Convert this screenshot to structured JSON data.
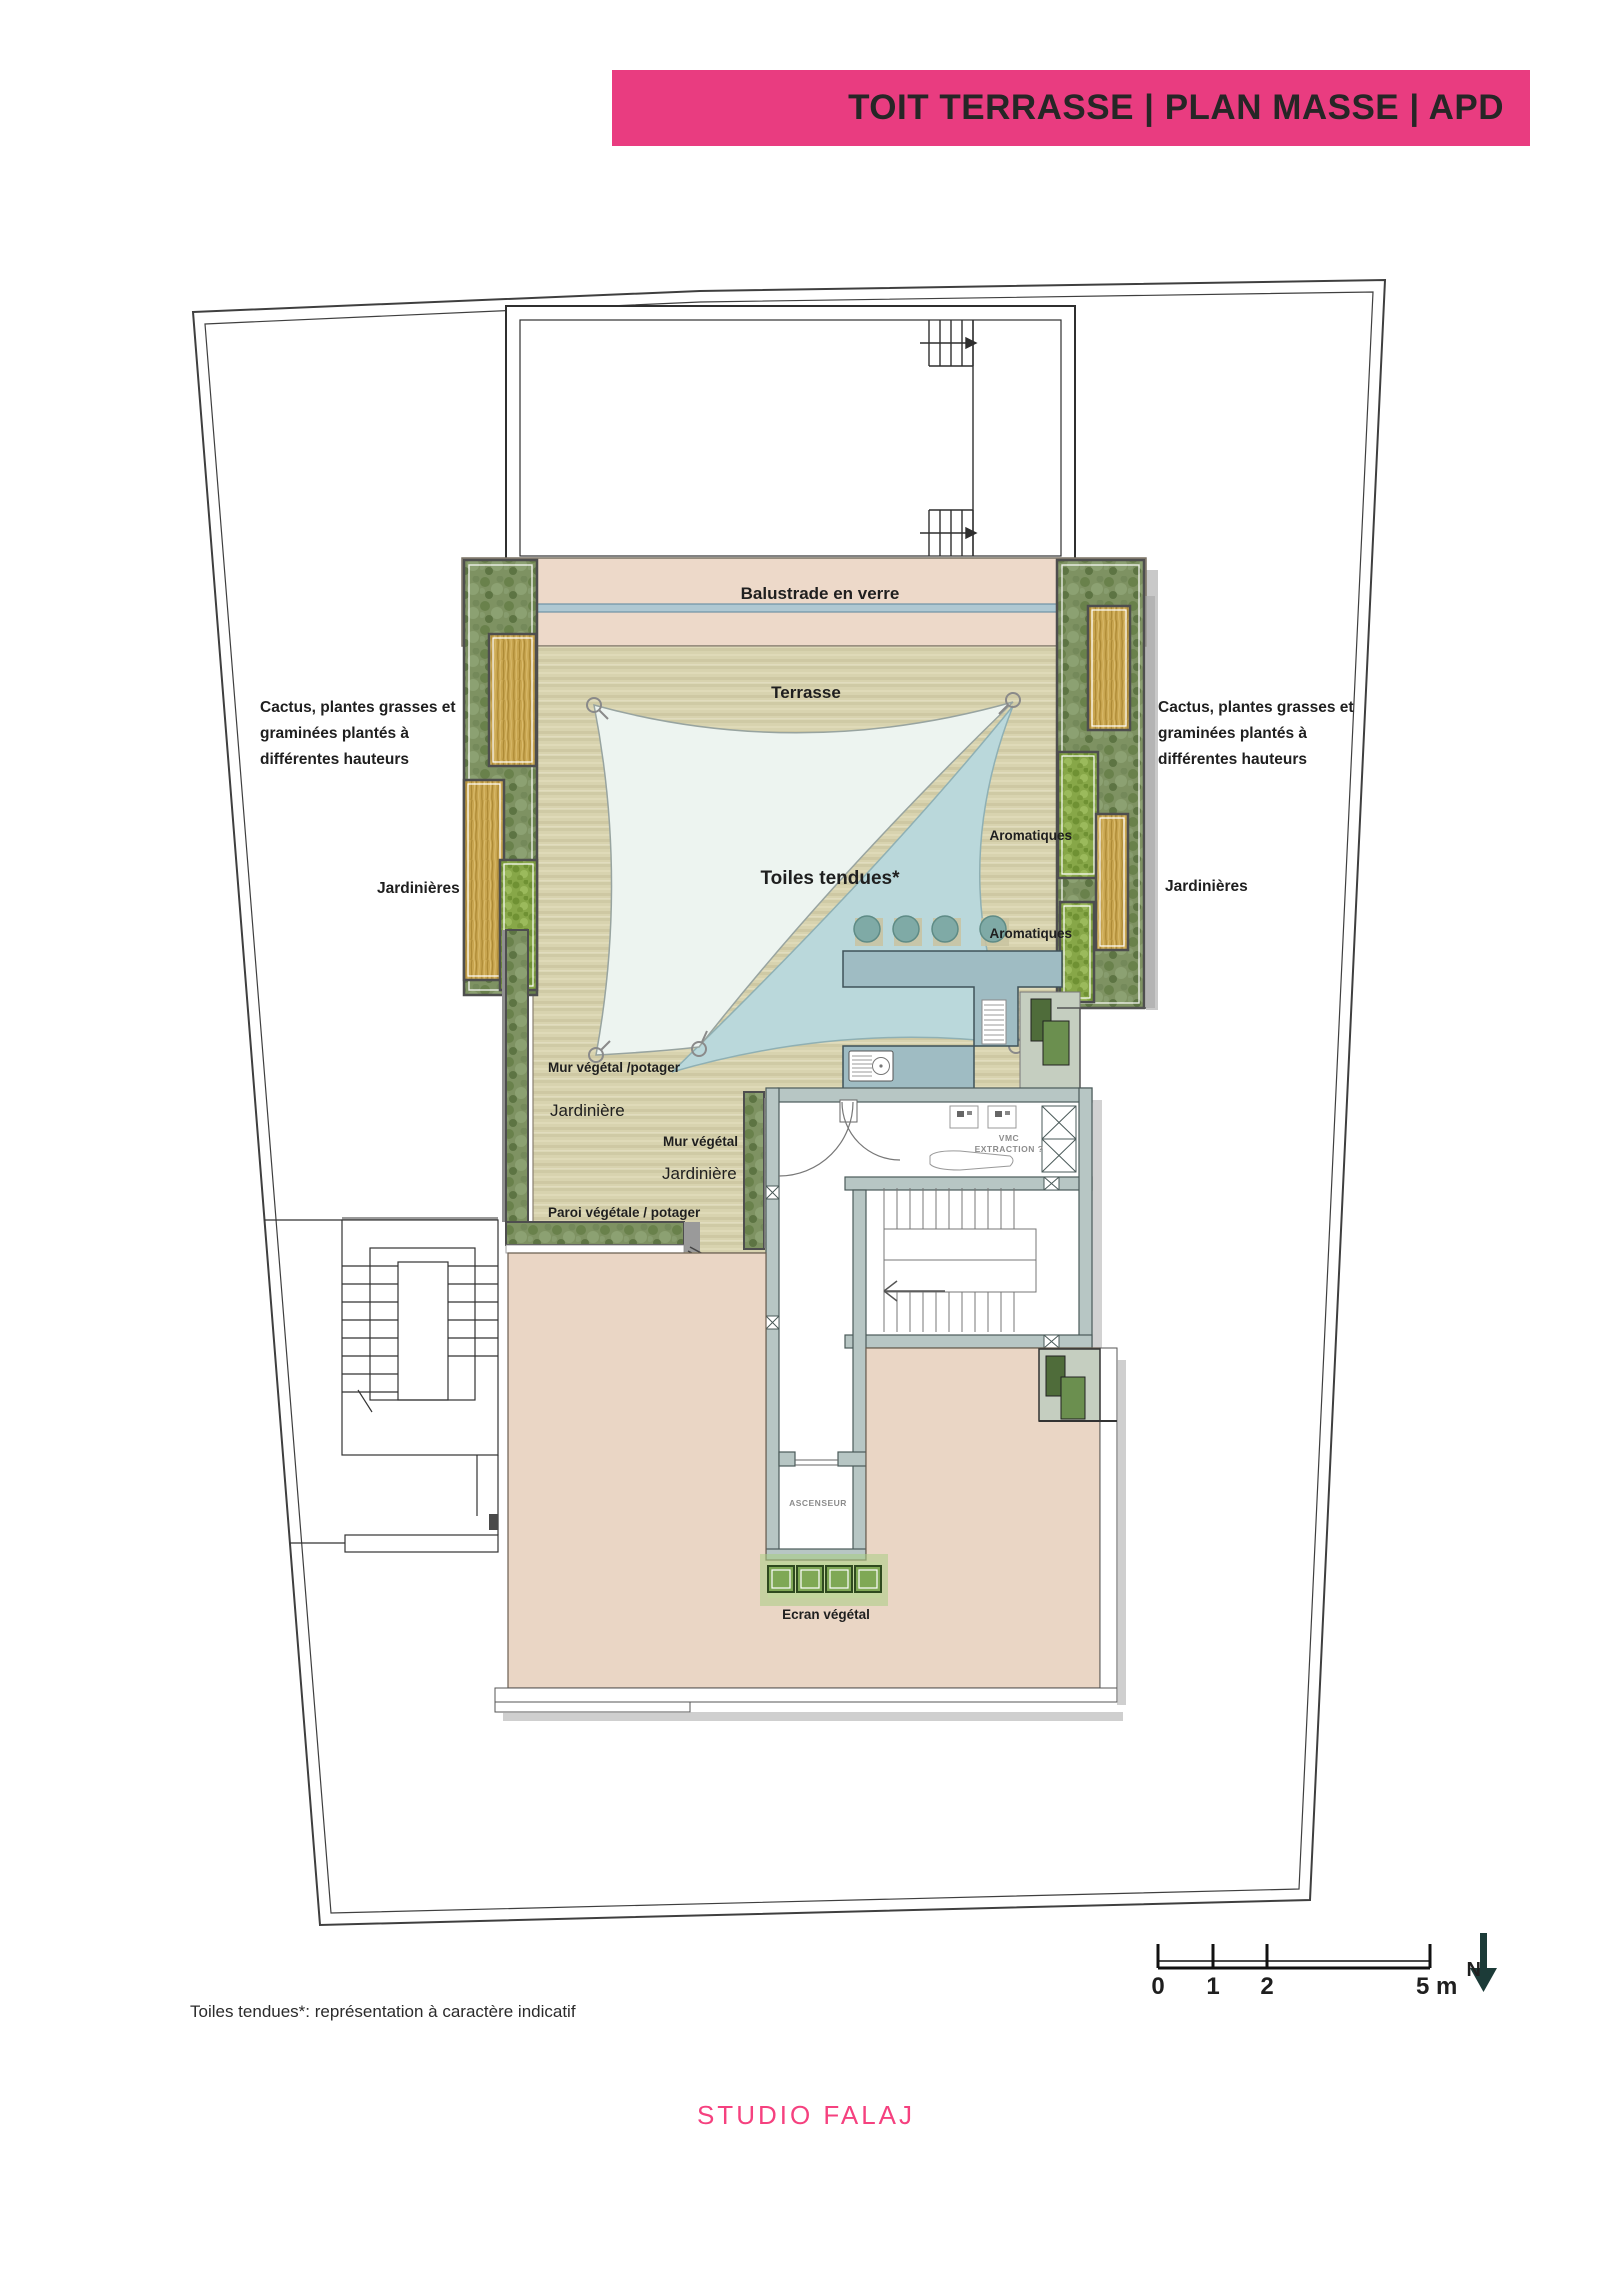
{
  "title_bar": {
    "text": "TOIT TERRASSE | PLAN MASSE | APD"
  },
  "colors": {
    "accent_pink": "#E93C80",
    "terrace_deck": "#D8D3AF",
    "balustrade_band": "#EDD9C9",
    "lower_terrace": "#EAD6C5",
    "counter_blue": "#9FBCC3",
    "wall_gray": "#B7C6C4"
  },
  "plan": {
    "labels": {
      "balustrade": "Balustrade en verre",
      "terrasse": "Terrasse",
      "toiles": "Toiles tendues*",
      "aromatiques_top": "Aromatiques",
      "aromatiques_bottom": "Aromatiques",
      "cactus_l1": "Cactus, plantes grasses et",
      "cactus_l2": "graminées plantés à",
      "cactus_l3": "différentes hauteurs",
      "jardinieres_left": "Jardinières",
      "jardinieres_right": "Jardinières",
      "mur_vegetal_potager": "Mur végétal /potager",
      "jardiniere_a": "Jardinière",
      "mur_vegetal": "Mur végétal",
      "jardiniere_b": "Jardinière",
      "paroi_vegetale": "Paroi végétale  / potager",
      "ecran_vegetal": "Ecran végétal",
      "ascenseur": "ASCENSEUR",
      "vmc_line1": "VMC",
      "vmc_line2": "EXTRACTION ?"
    },
    "scale": {
      "n0": "0",
      "n1": "1",
      "n2": "2",
      "n5": "5 m",
      "north": "N"
    }
  },
  "footnote": "Toiles tendues*: représentation à caractère indicatif",
  "studio": "STUDIO FALAJ"
}
